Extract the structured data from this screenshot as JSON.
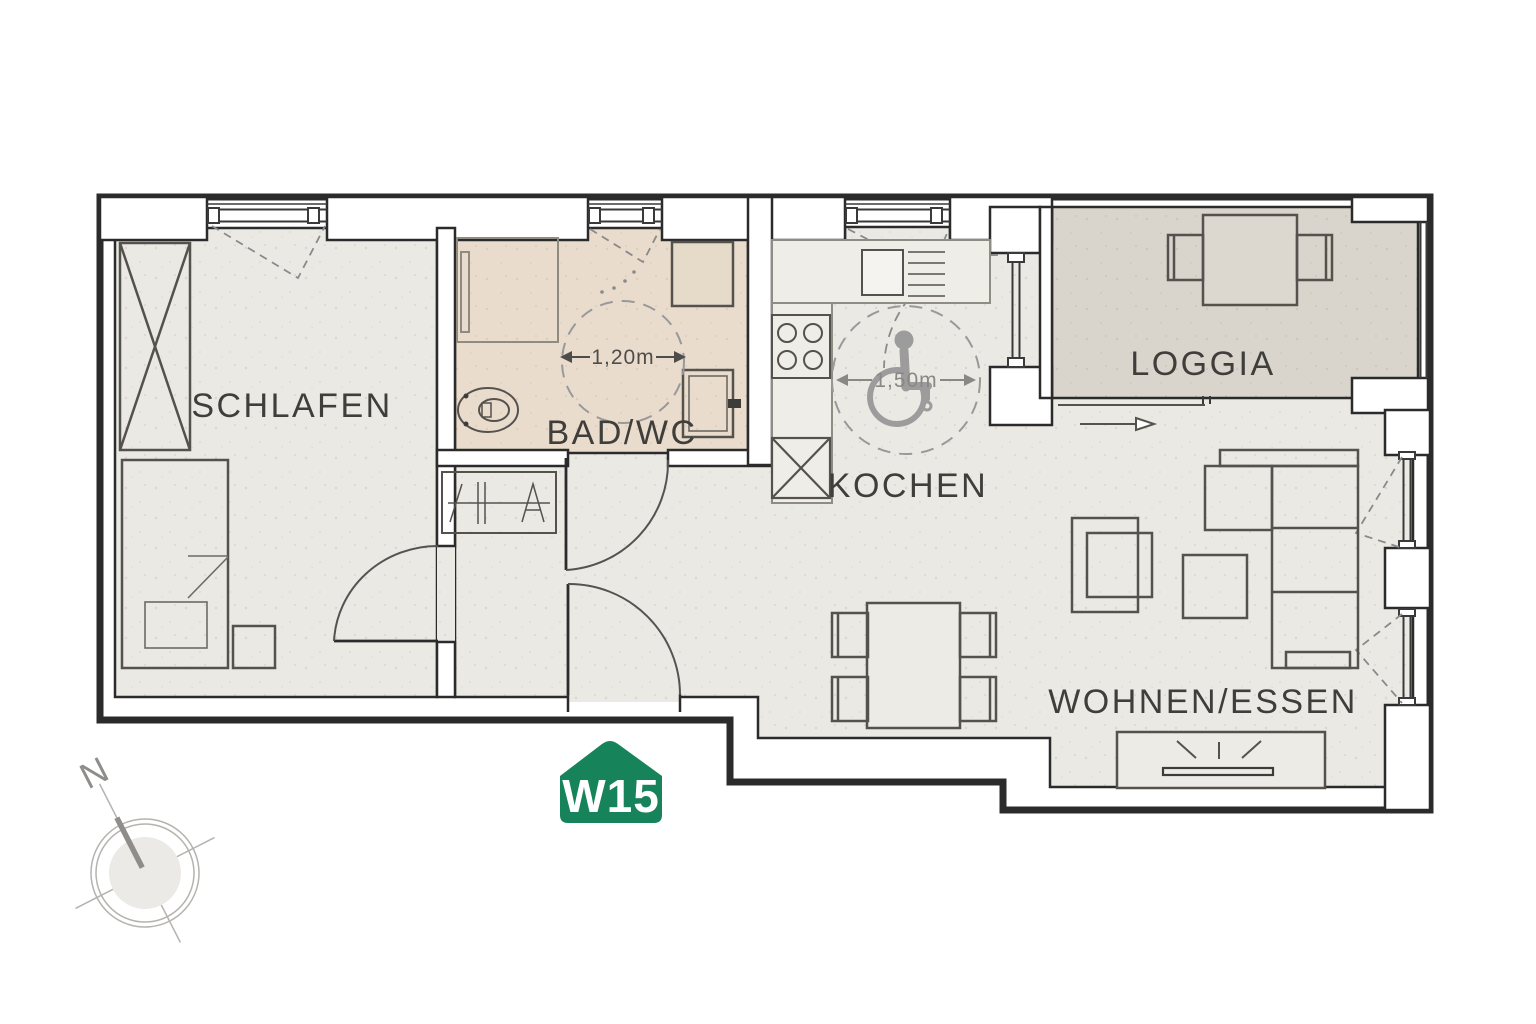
{
  "title": "Apartment floor plan",
  "badge": {
    "label": "W15",
    "color": "#16835a"
  },
  "rooms": {
    "schlafen": "SCHLAFEN",
    "bad_wc": "BAD/WC",
    "kochen": "KOCHEN",
    "loggia": "LOGGIA",
    "wohnen_essen": "WOHNEN/ESSEN"
  },
  "dimensions": {
    "bath_turning_circle": "1,20m",
    "kitchen_turning_circle": "1,50m"
  },
  "compass": {
    "north": "N"
  },
  "colors": {
    "wall_line": "#2b2b2b",
    "floor_main": "#ebe9e4",
    "floor_bath": "#e9dccd",
    "floor_loggia": "#d9d4cc",
    "badge_green": "#16835a",
    "accessibility_gray": "#9c9c9c"
  }
}
